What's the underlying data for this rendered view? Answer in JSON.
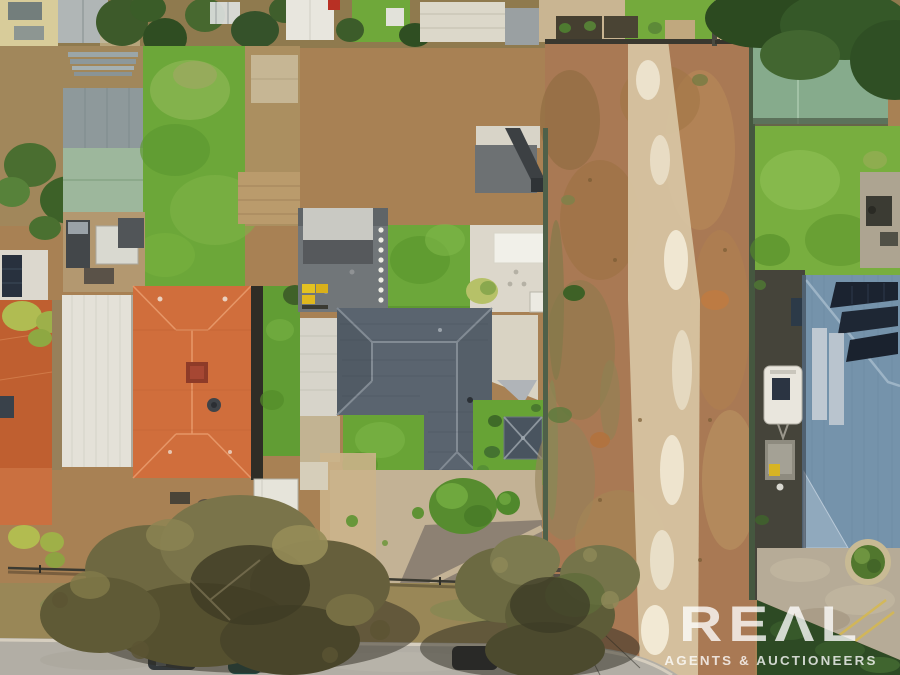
{
  "watermark": {
    "brand": "REAL",
    "brand_display": "REΛL",
    "tagline": "AGENTS & AUCTIONEERS",
    "color": "#ffffff"
  },
  "scene": {
    "type": "aerial-drone-photo",
    "subject": "suburban residential properties beside a vacant dirt land parcel, street with large gum trees at bottom",
    "features": [
      "vacant dirt lot with pale worn track",
      "charcoal hip-roof house with gravel front yard",
      "large terracotta tile roof house with chimney and satellite dish",
      "second terracotta roof house with solar panels",
      "white garage roof strip",
      "sage green garden sheds",
      "white machinery shed",
      "blue slate roof house with solar panel arrays",
      "white caravan and box trailer in side yard",
      "wheelie bins (yellow and green)",
      "shade gazebo with X frame",
      "green lawns and white paved courtyard",
      "street trees overhanging road",
      "parked cars on street",
      "power pole with transformers and lines",
      "dark front fencing",
      "circular garden bed on concrete driveway"
    ],
    "palette": {
      "terracotta_roof": "#d06e3c",
      "charcoal_roof": "#5a646f",
      "slate_blue_roof": "#7593ab",
      "sage_shed": "#86ab8c",
      "lawn_green": "#6ca739",
      "dirt_tan": "#a97954",
      "track_cream": "#d8c6a4",
      "road_grey": "#b2aea5",
      "gum_tree_olive": "#6e6841",
      "solar_panel": "#1b2330",
      "watermark_white": "#ffffff"
    }
  }
}
